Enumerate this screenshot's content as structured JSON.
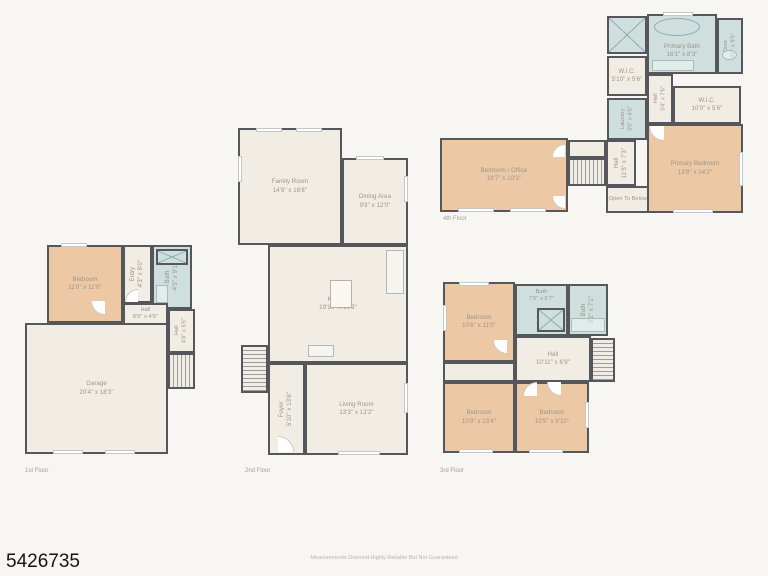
{
  "page": {
    "listing_id": "5426735",
    "disclaimer": "Measurements Deemed Highly Reliable But Not Guaranteed"
  },
  "colors": {
    "bg": "#f7f6f3",
    "wall": "#55575a",
    "cream": "#f2ede4",
    "bedroom": "#ecc9a4",
    "bath": "#cfdfde",
    "label": "#9a948a",
    "muted": "#a3a09b"
  },
  "floor1": {
    "label": "1st Floor",
    "garage": {
      "name": "Garage",
      "dims": "20'4\" x 18'3\""
    },
    "bedroom": {
      "name": "Bedroom",
      "dims": "11'0\" x 11'0\""
    },
    "entry": {
      "name": "Entry",
      "dims": "4'3\" x 8'0\""
    },
    "bath": {
      "name": "Bath",
      "dims": "4'5\" x 9'1\""
    },
    "hall": {
      "name": "Hall",
      "dims": "8'5\" x 4'6\""
    },
    "hall2": {
      "name": "Hall",
      "dims": "4'8\" x 5'5\""
    }
  },
  "floor2": {
    "label": "2nd Floor",
    "family_room": {
      "name": "Family Room",
      "dims": "14'6\" x 16'8\""
    },
    "dining_area": {
      "name": "Dining Area",
      "dims": "9'8\" x 12'0\""
    },
    "kitchen": {
      "name": "Kitchen",
      "dims": "19'10\" x 16'9\""
    },
    "foyer": {
      "name": "Foyer",
      "dims": "5'10\" x 13'6\""
    },
    "living_room": {
      "name": "Living Room",
      "dims": "13'3\" x 13'2\""
    }
  },
  "floor3": {
    "label": "3rd Floor",
    "bedroom_top": {
      "name": "Bedroom",
      "dims": "10'6\" x 11'0\""
    },
    "bath": {
      "name": "Bath",
      "dims": "7'6\" x 5'7\""
    },
    "bath2": {
      "name": "Bath",
      "dims": "9'2\" x 7'1\""
    },
    "hall": {
      "name": "Hall",
      "dims": "10'11\" x 6'9\""
    },
    "bedroom_left": {
      "name": "Bedroom",
      "dims": "10'9\" x 13'4\""
    },
    "bedroom_right": {
      "name": "Bedroom",
      "dims": "10'5\" x 9'10\""
    }
  },
  "floor4": {
    "label": "4th Floor",
    "bedroom_office": {
      "name": "Bedroom / Office",
      "dims": "19'7\" x 10'3\""
    },
    "hall_lower": {
      "name": "Hall",
      "dims": "11'5\" x 7'3\""
    },
    "open_to_below": {
      "name": "Open To Below"
    },
    "primary_bath": {
      "name": "Primary Bath",
      "dims": "16'1\" x 8'3\""
    },
    "door": {
      "name": "Door",
      "dims": "3'5\" x 8'5\""
    },
    "wic_small": {
      "name": "W.I.C.",
      "dims": "5'10\" x 5'6\""
    },
    "hall_upper": {
      "name": "Hall",
      "dims": "3'4\" x 7'6\""
    },
    "wic_large": {
      "name": "W.I.C.",
      "dims": "10'0\" x 5'6\""
    },
    "laundry": {
      "name": "Laundry",
      "dims": "3'6\" x 4'6\""
    },
    "primary_bedroom": {
      "name": "Primary Bedroom",
      "dims": "13'8\" x 14'2\""
    }
  }
}
